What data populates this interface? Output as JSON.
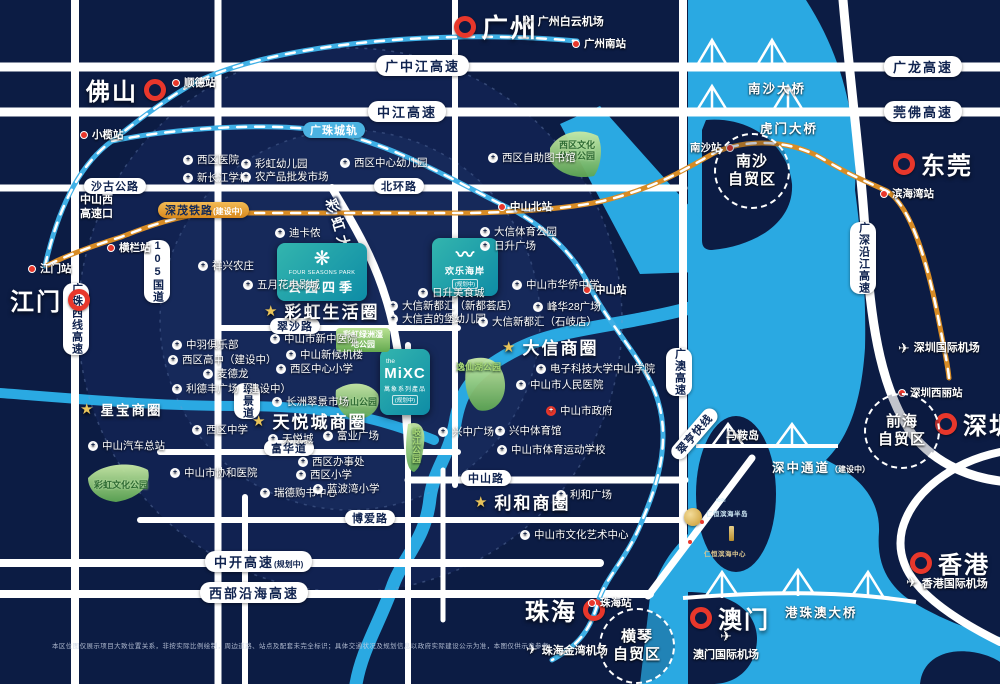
{
  "cities": {
    "guangzhou": "广州",
    "foshan": "佛山",
    "jiangmen": "江门",
    "dongguan": "东莞",
    "shenzhen": "深圳",
    "hongkong": "香港",
    "macau": "澳门",
    "zhuhai": "珠海"
  },
  "airports": {
    "baiyun": "广州白云机场",
    "jinwan": "珠海金湾机场",
    "macau": "澳门国际机场",
    "hongkong": "香港国际机场",
    "shenzhen": "深圳国际机场"
  },
  "stations": {
    "guangzhou_south": "广州南站",
    "shunde": "顺德站",
    "xiaolan": "小榄站",
    "henglan": "横栏站",
    "jiangmen": "江门站",
    "zhongshan_north": "中山北站",
    "zhongshan": "中山站",
    "nansha": "南沙站",
    "binhaiwan": "滨海湾站",
    "shenzhen_xili": "深圳西丽站",
    "zhuhai": "珠海站"
  },
  "roads": {
    "gzj": "广中江高速",
    "zj": "中江高速",
    "gl": "广龙高速",
    "wf": "莞佛高速",
    "bh": "北环路",
    "sg": "沙古公路",
    "xikou": "中山西高速口",
    "g105": "105国道",
    "gzx": "广珠西线高速",
    "cuijing": "翠景道",
    "caihong_ave": "彩虹大道",
    "cuisha": "翠沙路",
    "fuhua": "富华道",
    "zhongshan_rd": "中山路",
    "boai": "博爱路",
    "zhongkai": "中开高速",
    "zhongkai_note": "(规划中)",
    "xbyh": "西部沿海高速",
    "guangao": "广澳高速",
    "gssyj": "广深沿江高速",
    "cuiheng": "翠亨快线"
  },
  "rails": {
    "gzih": "广珠城轨",
    "shenmao": "深茂铁路",
    "shenmao_note": "(建设中)"
  },
  "bridges": {
    "nansha": "南沙大桥",
    "humen": "虎门大桥",
    "szt": "深中通道",
    "szt_note": "（建设中）",
    "hzm": "港珠澳大桥"
  },
  "zones": {
    "nansha": [
      "南沙",
      "自贸区"
    ],
    "qianhai": [
      "前海",
      "自贸区"
    ],
    "hengqin": [
      "横琴",
      "自贸区"
    ]
  },
  "biz": {
    "xingbao": "星宝商圈",
    "caihong": "彩虹生活圈",
    "tianyue": "天悦城商圈",
    "daxin": "大信商圈",
    "lihe": "利和商圈"
  },
  "parks": {
    "xiqu_wenhua": "西区文化休闲公园",
    "chlz": "彩虹绿洲湿地公园",
    "mashan": "马山公园",
    "qijiang": "岐江公园",
    "yixianhu": "逸仙湖公园",
    "chwh": "彩虹文化公园"
  },
  "landmarks": {
    "fsp_en": "FOUR SEASONS PARK",
    "fsp_cn": "公园四季",
    "happycoast_cn": "欢乐海岸",
    "happycoast_note": "(规划中)",
    "mixc_the": "the",
    "mixc_logo": "MiXC",
    "mixc_cn": "萬象系列產品",
    "mixc_note": "(规划中)",
    "maanshan": "马鞍岛",
    "renheng1": "仁恒滨海半岛",
    "renheng2": "仁恒滨海中心"
  },
  "pois": [
    "西区医院",
    "彩虹幼儿园",
    "西区中心幼儿园",
    "新长江学校",
    "农产品批发市场",
    "西区自助图书馆",
    "迪卡侬",
    "祥兴农庄",
    "五月花电影城",
    "中羽俱乐部",
    "西区高中（建设中）",
    "麦德龙",
    "利德丰广场（建设中）",
    "西区中学",
    "中山汽车总站",
    "中山市协和医院",
    "中山市新中医院",
    "中山新候机楼",
    "西区中心小学",
    "长洲翠景市场",
    "天悦城",
    "富业广场",
    "西区办事处",
    "西区小学",
    "瑞德购书中心",
    "蓝波湾小学",
    "日升美食城",
    "大信新都汇（新都荟店）",
    "大信吉的堡幼儿园",
    "大信体育公园",
    "日升广场",
    "中山市华侨中学",
    "峰华28广场",
    "大信新都汇（石岐店）",
    "电子科技大学中山学院",
    "中山市人民医院",
    "中山市政府",
    "兴中广场",
    "兴中体育馆",
    "中山市体育运动学校",
    "利和广场",
    "中山市文化艺术中心"
  ],
  "disclaimer": "本区位图仅展示项目大致位置关系，非按实际比例绘制，周边道路、站点及配套未完全标识；具体交通状况及规划信息以政府实际建设公示为准，本图仅供示意参考。"
}
